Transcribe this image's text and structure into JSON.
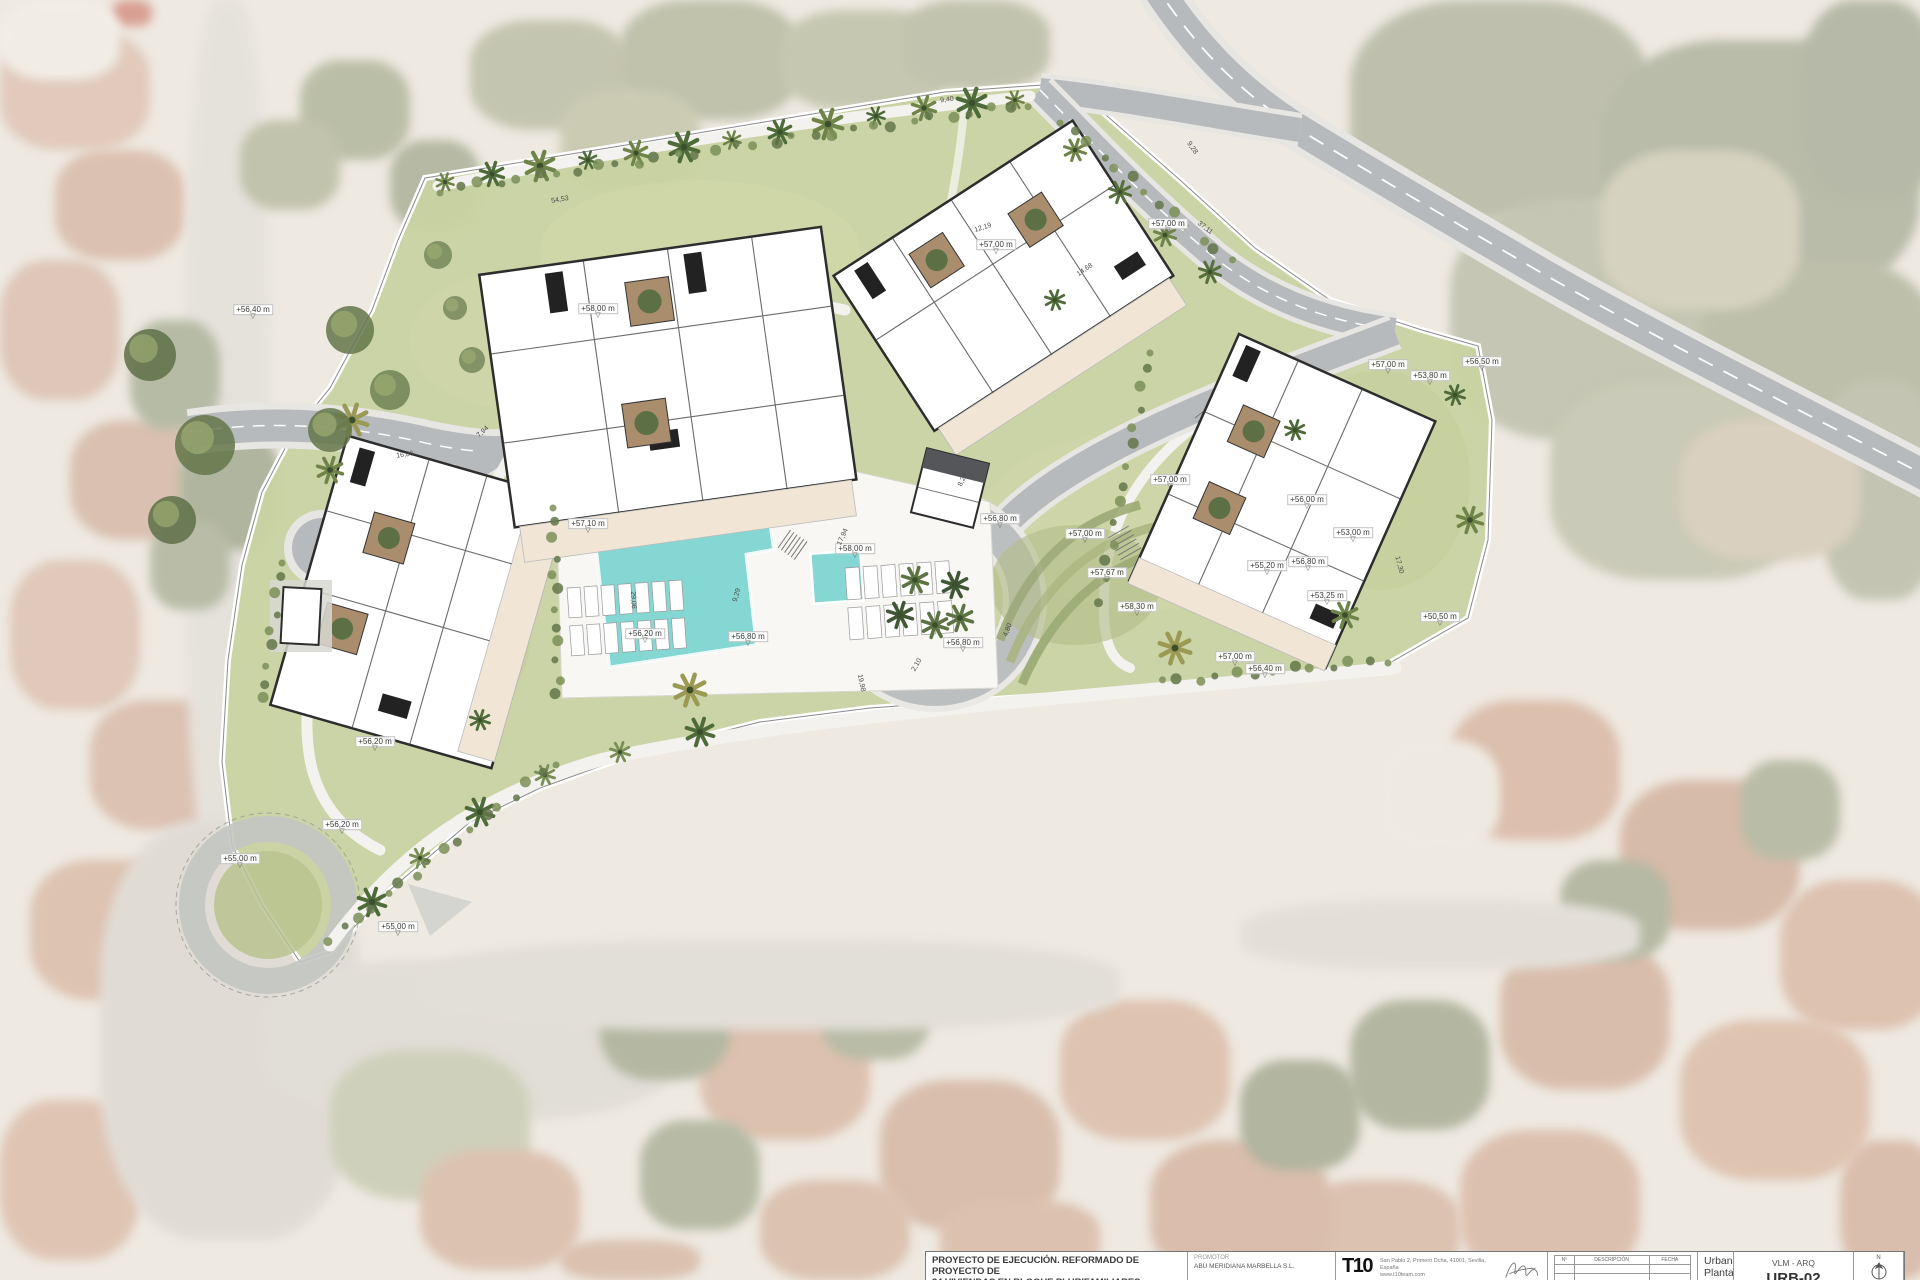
{
  "colors": {
    "lawn": "#c9d2a2",
    "road_asphalt": "#b7babc",
    "sidewalk": "#e9e8e3",
    "pool_water": "#84d7d2",
    "terrace_beige": "#f1e6d6",
    "building_wall": "#2d2d2d",
    "hedge_green": "#63754a",
    "canopy_dark": "#55565a"
  },
  "plan": {
    "elevation_labels": [
      {
        "text": "+56,40 m",
        "x": 253,
        "y": 313
      },
      {
        "text": "+57,10 m",
        "x": 588,
        "y": 527
      },
      {
        "text": "+58,00 m",
        "x": 598,
        "y": 312
      },
      {
        "text": "+58,00 m",
        "x": 855,
        "y": 552
      },
      {
        "text": "+56,20 m",
        "x": 645,
        "y": 637
      },
      {
        "text": "+56,80 m",
        "x": 748,
        "y": 640
      },
      {
        "text": "+56,80 m",
        "x": 963,
        "y": 646
      },
      {
        "text": "+56,80 m",
        "x": 1000,
        "y": 522
      },
      {
        "text": "+57,00 m",
        "x": 996,
        "y": 248
      },
      {
        "text": "+57,00 m",
        "x": 1168,
        "y": 227
      },
      {
        "text": "+57,00 m",
        "x": 1085,
        "y": 537
      },
      {
        "text": "+57,67 m",
        "x": 1107,
        "y": 576
      },
      {
        "text": "+58,30 m",
        "x": 1137,
        "y": 610
      },
      {
        "text": "+57,00 m",
        "x": 1170,
        "y": 483
      },
      {
        "text": "+56,00 m",
        "x": 1307,
        "y": 503
      },
      {
        "text": "+53,00 m",
        "x": 1353,
        "y": 536
      },
      {
        "text": "+56,80 m",
        "x": 1308,
        "y": 565
      },
      {
        "text": "+55,20 m",
        "x": 1267,
        "y": 569
      },
      {
        "text": "+53,25 m",
        "x": 1327,
        "y": 599
      },
      {
        "text": "+50,50 m",
        "x": 1440,
        "y": 620
      },
      {
        "text": "+57,00 m",
        "x": 1235,
        "y": 660
      },
      {
        "text": "+56,40 m",
        "x": 1265,
        "y": 672
      },
      {
        "text": "+57,00 m",
        "x": 1388,
        "y": 368
      },
      {
        "text": "+53,80 m",
        "x": 1430,
        "y": 379
      },
      {
        "text": "+56,50 m",
        "x": 1482,
        "y": 365
      },
      {
        "text": "+56,20 m",
        "x": 375,
        "y": 745
      },
      {
        "text": "+56,20 m",
        "x": 342,
        "y": 828
      },
      {
        "text": "+55,00 m",
        "x": 398,
        "y": 930
      },
      {
        "text": "+55,00 m",
        "x": 240,
        "y": 862
      }
    ],
    "dimension_labels": [
      {
        "text": "54,53",
        "x": 560,
        "y": 200,
        "rot": -10
      },
      {
        "text": "9,40",
        "x": 947,
        "y": 100,
        "rot": -8
      },
      {
        "text": "37,11",
        "x": 1205,
        "y": 228,
        "rot": 38
      },
      {
        "text": "17,94",
        "x": 843,
        "y": 537,
        "rot": -65
      },
      {
        "text": "12,19",
        "x": 983,
        "y": 228,
        "rot": -18
      },
      {
        "text": "14,68",
        "x": 1085,
        "y": 270,
        "rot": -35
      },
      {
        "text": "16,86",
        "x": 405,
        "y": 455,
        "rot": -8
      },
      {
        "text": "7,94",
        "x": 483,
        "y": 432,
        "rot": -42
      },
      {
        "text": "9,29",
        "x": 737,
        "y": 595,
        "rot": -75
      },
      {
        "text": "29,06",
        "x": 633,
        "y": 600,
        "rot": 87
      },
      {
        "text": "2,10",
        "x": 917,
        "y": 665,
        "rot": -60
      },
      {
        "text": "19,98",
        "x": 861,
        "y": 683,
        "rot": 78
      },
      {
        "text": "4,80",
        "x": 1008,
        "y": 630,
        "rot": -68
      },
      {
        "text": "17,30",
        "x": 1399,
        "y": 565,
        "rot": 75
      },
      {
        "text": "8,29",
        "x": 963,
        "y": 480,
        "rot": -65
      },
      {
        "text": "9,28",
        "x": 1192,
        "y": 148,
        "rot": 55
      }
    ]
  },
  "title_block": {
    "project_title_line1": "PROYECTO DE EJECUCIÓN.  REFORMADO DE PROYECTO DE",
    "project_title_line2": "34 VIVIENDAS EN BLOQUE PLURIFAMILIARES",
    "promoter_label": "PROMOTOR",
    "promoter_name": "ABU MERIDIANA MARBELLA S.L.",
    "firm_logo": "T10",
    "firm_address_line1": "San Pablo 2, Primero Dcha, 41001, Sevilla, España",
    "firm_address_line2": "www.t10team.com",
    "revision_table": {
      "headers": [
        "Nº",
        "DESCRIPCIÓN",
        "FECHA"
      ]
    },
    "drawing_title": "Urbanización. Planta Baja",
    "project_code": "VLM - ARQ",
    "sheet_number": "URB-02",
    "north_label": "N"
  }
}
